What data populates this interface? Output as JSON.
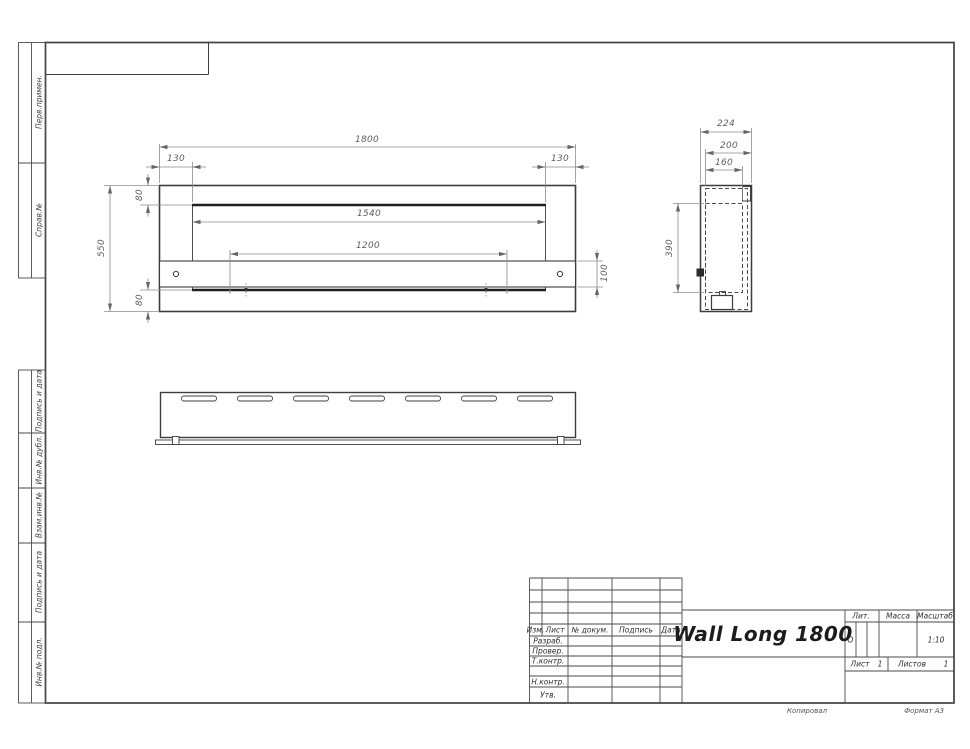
{
  "front_view": {
    "dim_total_width": "1800",
    "dim_left_inset": "130",
    "dim_right_inset": "130",
    "dim_opening_width": "1540",
    "dim_mount_span": "1200",
    "dim_total_height": "550",
    "dim_top_flange": "80",
    "dim_bottom_flange": "80",
    "dim_shelf_height": "100"
  },
  "side_view": {
    "dim_depth": "224",
    "dim_inner_depth": "200",
    "dim_opening_depth": "160",
    "dim_inner_height": "390"
  },
  "margin_labels": [
    "Перв.примен.",
    "Справ.№",
    "Подпись и дата",
    "Инв.№ дубл.",
    "Взам.инв.№",
    "Подпись и дата",
    "Инв.№ подл."
  ],
  "title_block": {
    "doc_title": "Wall Long 1800",
    "col_izm": "Изм.",
    "col_list": "Лист",
    "col_ndocum": "№ докум.",
    "col_podpis": "Подпись",
    "col_data": "Дата",
    "row_razrab": "Разраб.",
    "row_prover": "Провер.",
    "row_tkontr": "Т.контр.",
    "row_nkontr": "Н.контр.",
    "row_utv": "Утв.",
    "lit_label": "Лит.",
    "lit_value": "О",
    "massa_label": "Масса",
    "masshtab_label": "Масштаб",
    "masshtab_value": "1:10",
    "list_label": "Лист",
    "sheet_number": "1",
    "listov_label": "Листов",
    "sheets_total": "1"
  },
  "footer": {
    "kopiroval": "Копировал",
    "format": "Формат А3"
  }
}
